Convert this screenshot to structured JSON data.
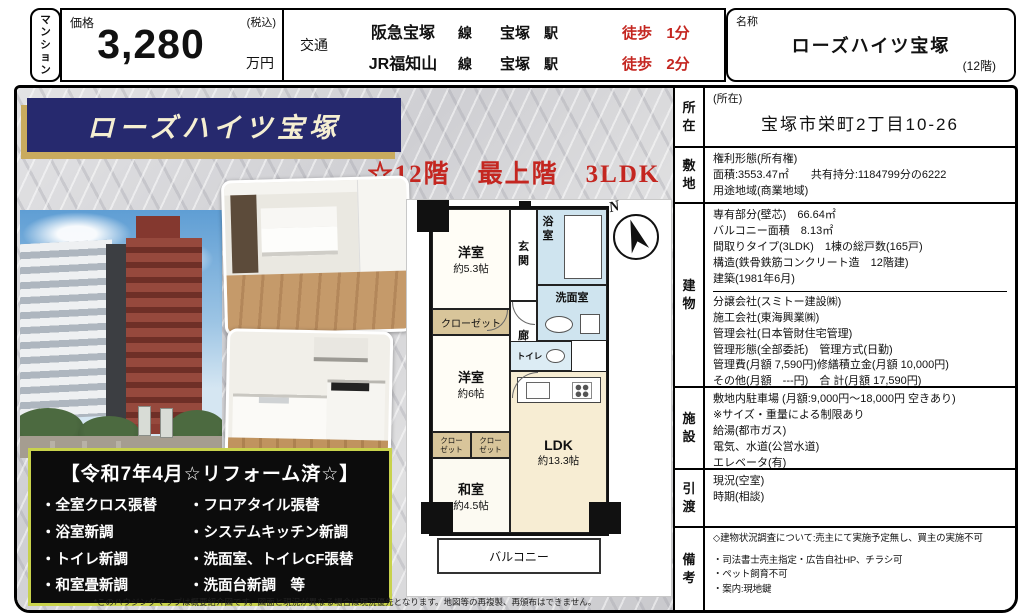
{
  "header": {
    "type_label": "マンション",
    "price": {
      "label": "価格",
      "tax": "(税込)",
      "amount": "3,280",
      "unit": "万円"
    },
    "access": {
      "label": "交通",
      "routes": [
        {
          "line": "阪急宝塚",
          "line_sfx": "線",
          "station": "宝塚",
          "station_sfx": "駅",
          "walk": "徒歩",
          "min": "1分"
        },
        {
          "line": "JR福知山",
          "line_sfx": "線",
          "station": "宝塚",
          "station_sfx": "駅",
          "walk": "徒歩",
          "min": "2分"
        }
      ]
    },
    "name": {
      "label": "名称",
      "value": "ローズハイツ宝塚",
      "floor": "(12階)"
    }
  },
  "left": {
    "banner": "ローズハイツ宝塚",
    "catch": "☆12階　最上階　3LDK",
    "reform": {
      "title": "【令和7年4月☆リフォーム済☆】",
      "left": [
        "・全室クロス張替",
        "・浴室新調",
        "・トイレ新調",
        "・和室畳新調"
      ],
      "right": [
        "・フロアタイル張替",
        "・システムキッチン新調",
        "・洗面室、トイレCF張替",
        "・洗面台新調　等"
      ]
    },
    "disclaimer": "*このハウジングマップは概要紹介図です。図面と現況が異なる場合は現況優先となります。地図等の再複製、再頒布はできません。"
  },
  "floorplan": {
    "compass": "N",
    "bedroom1": "洋室",
    "bedroom1_size": "約5.3帖",
    "closet": "クローゼット",
    "bedroom2": "洋室",
    "bedroom2_size": "約6帖",
    "closet_a": "クローゼット",
    "closet_b": "クローゼット",
    "washitsu": "和室",
    "washitsu_size": "約4.5帖",
    "entrance": "玄関",
    "hall": "廊下",
    "bath": "浴室",
    "washroom": "洗面室",
    "toilet": "トイレ",
    "ldk": "LDK",
    "ldk_size": "約13.3帖",
    "balcony": "バルコニー"
  },
  "details": {
    "rows": [
      {
        "label": "所在",
        "lines": [
          "(所在)",
          "宝塚市栄町2丁目10-26"
        ]
      },
      {
        "label": "敷地",
        "lines": [
          "権利形態(所有権)",
          "面積:3553.47㎡　　共有持分:1184799分の6222",
          "用途地域(商業地域)"
        ]
      },
      {
        "label": "建物",
        "block1": [
          "専有部分(壁芯)　66.64㎡",
          "バルコニー面積　8.13㎡",
          "間取りタイプ(3LDK)　1棟の総戸数(165戸)",
          "構造(鉄骨鉄筋コンクリート造　12階建)",
          "建築(1981年6月)"
        ],
        "block2": [
          "分譲会社(スミトー建設㈱)",
          "施工会社(東海興業㈱)",
          "管理会社(日本管財住宅管理)",
          "管理形態(全部委託)　管理方式(日勤)",
          "管理費(月額 7,590円)修繕積立金(月額 10,000円)",
          "その他(月額　---円)　合 計(月額 17,590円)"
        ]
      },
      {
        "label": "施設",
        "lines": [
          "敷地内駐車場 (月額:9,000円〜18,000円 空きあり)",
          "※サイズ・重量による制限あり",
          "給湯(都市ガス)",
          "電気、水道(公営水道)",
          "エレベータ(有)"
        ]
      },
      {
        "label": "引渡",
        "lines": [
          "現況(空室)",
          "時期(相談)"
        ]
      },
      {
        "label": "備考",
        "lines": [
          "◇建物状況調査について:売主にて実施予定無し、買主の実施不可",
          "・司法書士売主指定・広告自社HP、チラシ可",
          "・ペット飼育不可",
          "・案内:現地鍵"
        ]
      }
    ]
  },
  "colors": {
    "accent_red": "#c42620",
    "banner_navy": "#26296e",
    "banner_gold": "#c9ab5e",
    "reform_border": "#c8d24c",
    "plan_cream": "#f7edd3",
    "plan_blue": "#cfe4ef",
    "plan_tan": "#d8c59a"
  }
}
